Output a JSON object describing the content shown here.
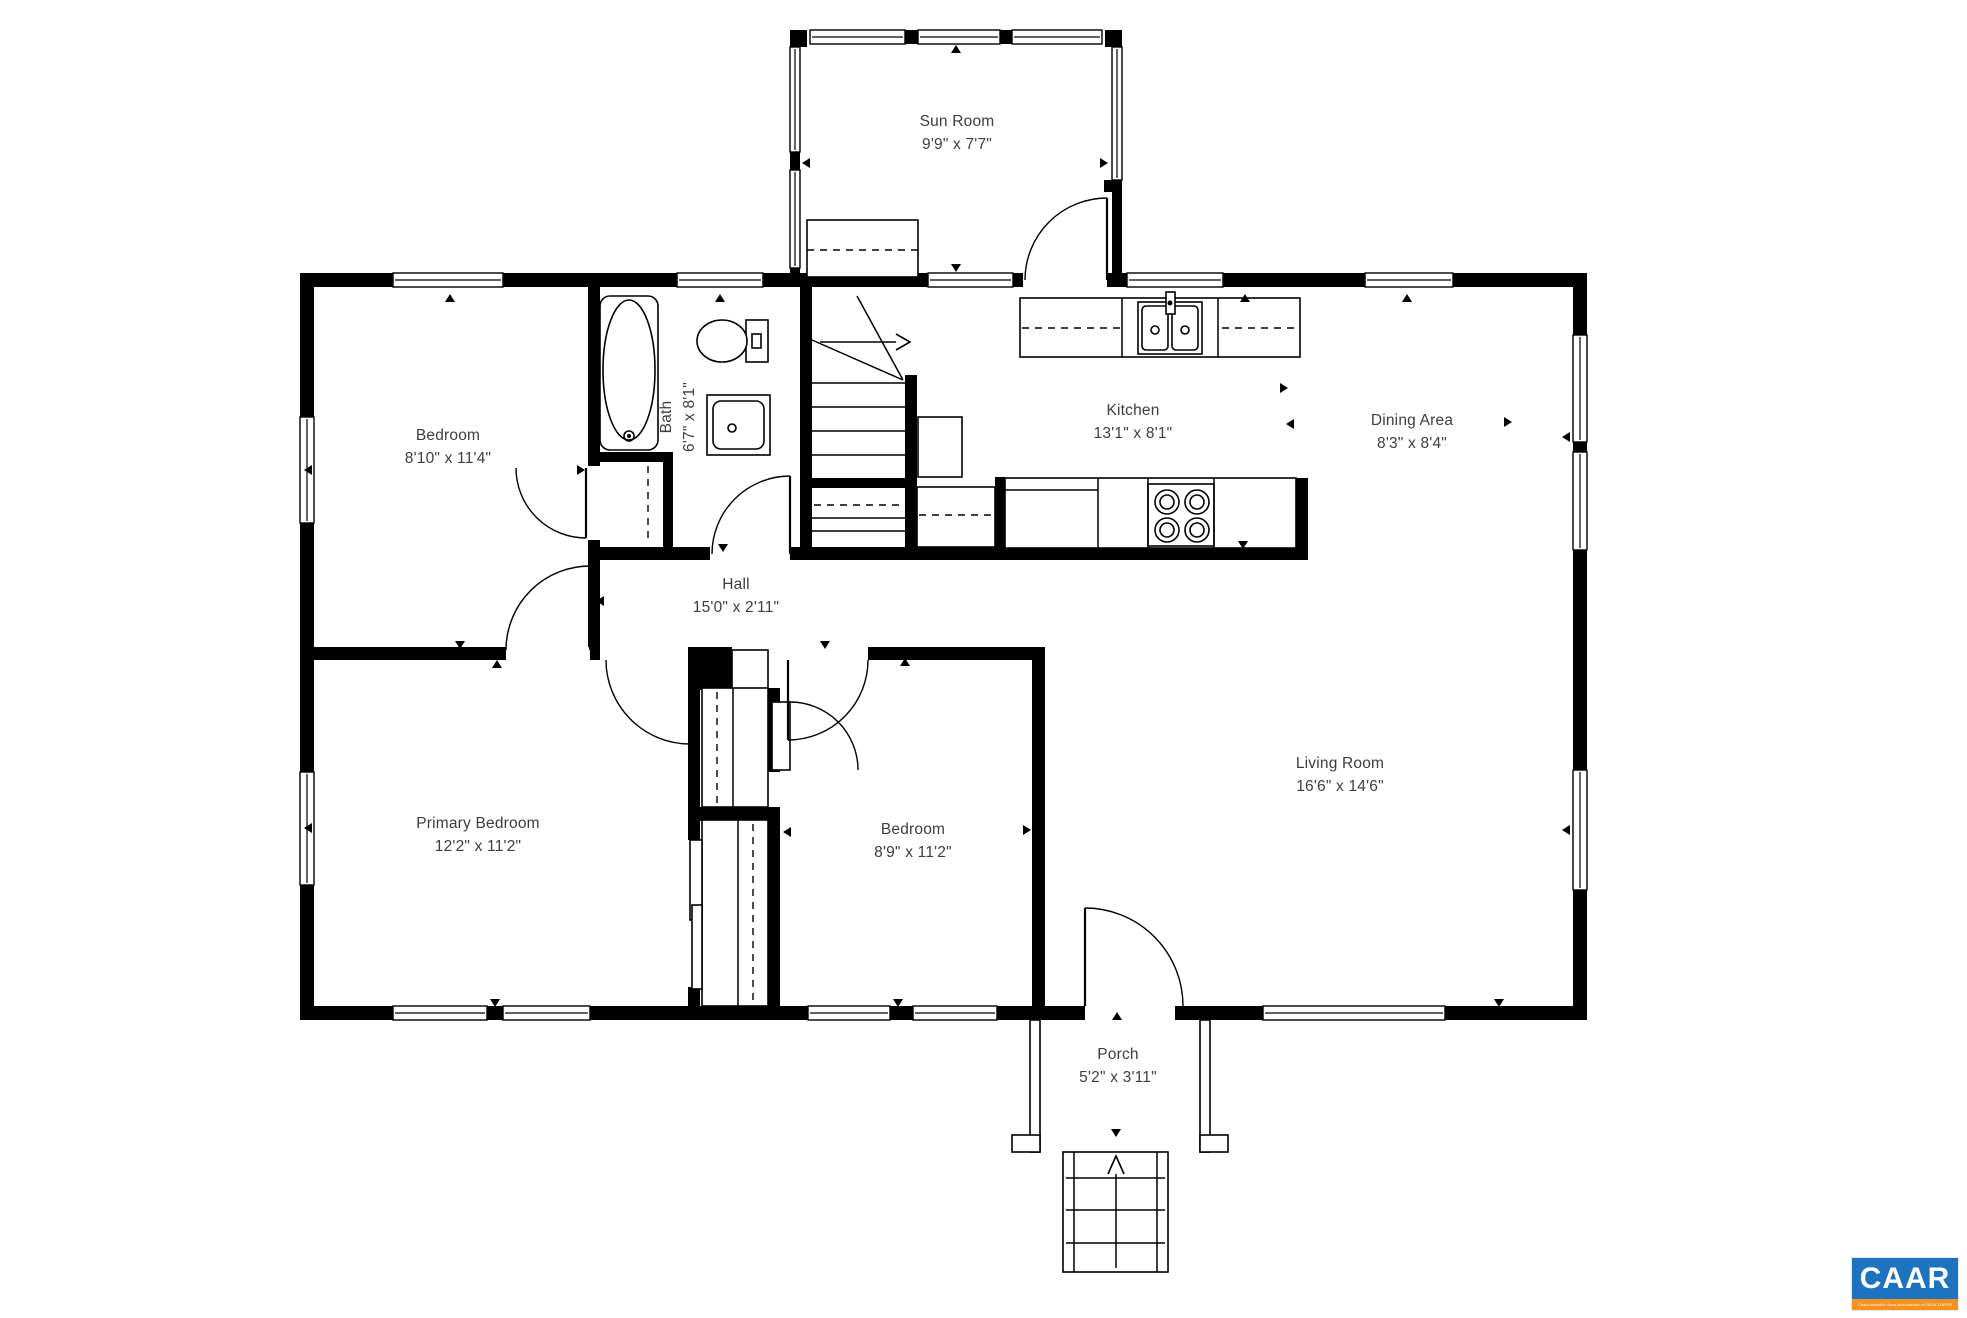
{
  "page": {
    "width": 1967,
    "height": 1318,
    "background": "#ffffff",
    "ink": "#000000",
    "label_color": "#3d3d3d"
  },
  "branding": {
    "logo_text": "CAAR",
    "logo_subtext": "Charlottesville Area Association of REALTORS®",
    "logo_blue": "#1e73be",
    "logo_orange": "#f6921e",
    "x": 1852,
    "y": 1258,
    "w": 106,
    "h": 52
  },
  "rooms": [
    {
      "id": "sun-room",
      "name": "Sun Room",
      "dims": "9'9\" x 7'7\"",
      "x": 957,
      "y": 133,
      "rot": false
    },
    {
      "id": "bedroom-top",
      "name": "Bedroom",
      "dims": "8'10\" x 11'4\"",
      "x": 448,
      "y": 447,
      "rot": false
    },
    {
      "id": "bath",
      "name": "Bath",
      "dims": "6'7\" x 8'1\"",
      "x": 678,
      "y": 417,
      "rot": true
    },
    {
      "id": "kitchen",
      "name": "Kitchen",
      "dims": "13'1\" x 8'1\"",
      "x": 1133,
      "y": 422,
      "rot": false
    },
    {
      "id": "dining-area",
      "name": "Dining Area",
      "dims": "8'3\" x 8'4\"",
      "x": 1412,
      "y": 432,
      "rot": false
    },
    {
      "id": "hall",
      "name": "Hall",
      "dims": "15'0\" x 2'11\"",
      "x": 736,
      "y": 596,
      "rot": false
    },
    {
      "id": "primary-bedroom",
      "name": "Primary Bedroom",
      "dims": "12'2\" x 11'2\"",
      "x": 478,
      "y": 835,
      "rot": false
    },
    {
      "id": "bedroom-bottom",
      "name": "Bedroom",
      "dims": "8'9\" x 11'2\"",
      "x": 913,
      "y": 841,
      "rot": false
    },
    {
      "id": "living-room",
      "name": "Living Room",
      "dims": "16'6\" x 14'6\"",
      "x": 1340,
      "y": 775,
      "rot": false
    },
    {
      "id": "porch",
      "name": "Porch",
      "dims": "5'2\" x 3'11\"",
      "x": 1118,
      "y": 1066,
      "rot": false
    }
  ],
  "plan": {
    "walls": [
      [
        300,
        273,
        93,
        14
      ],
      [
        503,
        273,
        174,
        14
      ],
      [
        763,
        273,
        165,
        14
      ],
      [
        1013,
        273,
        10,
        14
      ],
      [
        1107,
        273,
        20,
        14
      ],
      [
        1223,
        273,
        142,
        14
      ],
      [
        1453,
        273,
        134,
        14
      ],
      [
        300,
        1006,
        93,
        14
      ],
      [
        487,
        1006,
        16,
        14
      ],
      [
        590,
        1006,
        218,
        14
      ],
      [
        890,
        1006,
        23,
        14
      ],
      [
        997,
        1006,
        88,
        14
      ],
      [
        1175,
        1006,
        88,
        14
      ],
      [
        1445,
        1006,
        142,
        14
      ],
      [
        300,
        273,
        14,
        144
      ],
      [
        300,
        523,
        14,
        249
      ],
      [
        300,
        885,
        14,
        135
      ],
      [
        1573,
        273,
        14,
        62
      ],
      [
        1573,
        442,
        14,
        10
      ],
      [
        1573,
        550,
        14,
        220
      ],
      [
        1573,
        890,
        14,
        130
      ],
      [
        790,
        30,
        17,
        17
      ],
      [
        1105,
        30,
        17,
        17
      ],
      [
        905,
        30,
        13,
        14
      ],
      [
        1000,
        30,
        12,
        14
      ],
      [
        790,
        152,
        10,
        18
      ],
      [
        790,
        268,
        10,
        19
      ],
      [
        1112,
        180,
        10,
        93
      ],
      [
        1104,
        180,
        18,
        12
      ],
      [
        588,
        287,
        12,
        179
      ],
      [
        588,
        540,
        12,
        107
      ],
      [
        592,
        452,
        81,
        10
      ],
      [
        663,
        462,
        10,
        85
      ],
      [
        800,
        287,
        12,
        273
      ],
      [
        905,
        375,
        12,
        185
      ],
      [
        812,
        478,
        93,
        10
      ],
      [
        590,
        547,
        120,
        13
      ],
      [
        790,
        547,
        518,
        13
      ],
      [
        995,
        477,
        10,
        70
      ],
      [
        1296,
        478,
        12,
        69
      ],
      [
        300,
        647,
        206,
        13
      ],
      [
        590,
        647,
        10,
        13
      ],
      [
        868,
        647,
        177,
        13
      ],
      [
        688,
        647,
        44,
        43
      ],
      [
        688,
        650,
        12,
        190
      ],
      [
        688,
        807,
        92,
        14
      ],
      [
        768,
        688,
        12,
        84
      ],
      [
        768,
        820,
        12,
        186
      ],
      [
        688,
        987,
        12,
        19
      ],
      [
        1032,
        647,
        13,
        359
      ]
    ],
    "windows": [
      [
        393,
        273,
        110,
        14
      ],
      [
        677,
        273,
        86,
        14
      ],
      [
        1127,
        273,
        96,
        14
      ],
      [
        1365,
        273,
        88,
        14
      ],
      [
        393,
        1006,
        94,
        14
      ],
      [
        503,
        1006,
        87,
        14
      ],
      [
        808,
        1006,
        82,
        14
      ],
      [
        913,
        1006,
        84,
        14
      ],
      [
        1263,
        1006,
        182,
        14
      ],
      [
        300,
        417,
        14,
        106
      ],
      [
        300,
        772,
        14,
        113
      ],
      [
        1573,
        335,
        14,
        107
      ],
      [
        1573,
        452,
        14,
        98
      ],
      [
        1573,
        770,
        14,
        120
      ],
      [
        810,
        30,
        95,
        14
      ],
      [
        918,
        30,
        82,
        14
      ],
      [
        1012,
        30,
        90,
        14
      ],
      [
        790,
        47,
        10,
        105
      ],
      [
        790,
        170,
        10,
        98
      ],
      [
        1112,
        47,
        10,
        133
      ],
      [
        928,
        273,
        85,
        14
      ]
    ],
    "fixture_rects": [
      {
        "r": [
          600,
          296,
          58,
          154
        ],
        "rx": 10,
        "n": "bathtub"
      },
      {
        "r": [
          707,
          395,
          63,
          60
        ],
        "n": "bath-vanity"
      },
      {
        "r": [
          713,
          401,
          51,
          48
        ],
        "rx": 8,
        "n": "bath-sink-basin"
      },
      {
        "r": [
          746,
          320,
          22,
          42
        ],
        "n": "toilet-tank"
      },
      {
        "r": [
          752,
          334,
          9,
          14
        ],
        "n": "toilet-flush"
      },
      {
        "r": [
          918,
          417,
          44,
          60
        ],
        "n": "refrigerator"
      },
      {
        "r": [
          807,
          220,
          111,
          57
        ],
        "n": "sunroom-cabinet"
      },
      {
        "r": [
          1020,
          298,
          280,
          59
        ],
        "n": "kitchen-counter-top"
      },
      {
        "r": [
          1138,
          302,
          64,
          52
        ],
        "n": "kitchen-sink"
      },
      {
        "r": [
          1142,
          306,
          26,
          44
        ],
        "rx": 4,
        "n": "sink-bowl-left"
      },
      {
        "r": [
          1172,
          306,
          26,
          44
        ],
        "rx": 4,
        "n": "sink-bowl-right"
      },
      {
        "r": [
          1166,
          292,
          9,
          22
        ],
        "n": "sink-faucet"
      },
      {
        "r": [
          917,
          487,
          78,
          60
        ],
        "n": "cabinet-under-stair"
      },
      {
        "r": [
          1005,
          478,
          291,
          70
        ],
        "n": "kitchen-counter-bottom"
      },
      {
        "r": [
          1148,
          484,
          66,
          62
        ],
        "n": "stove"
      },
      {
        "r": [
          732,
          650,
          36,
          40
        ],
        "n": "closet-panel"
      },
      {
        "r": [
          702,
          688,
          66,
          119
        ],
        "n": "closet-upper"
      },
      {
        "r": [
          772,
          702,
          18,
          68
        ],
        "n": "closet-door-leaf"
      },
      {
        "r": [
          702,
          820,
          66,
          186
        ],
        "n": "closet-lower"
      },
      {
        "r": [
          690,
          840,
          12,
          80
        ],
        "n": "slider-panel-1"
      },
      {
        "r": [
          692,
          905,
          10,
          84
        ],
        "n": "slider-panel-2"
      },
      {
        "r": [
          1063,
          1152,
          105,
          120
        ],
        "n": "porch-steps"
      },
      {
        "r": [
          1030,
          1020,
          10,
          132
        ],
        "n": "porch-wall-left"
      },
      {
        "r": [
          1200,
          1020,
          10,
          132
        ],
        "n": "porch-wall-right"
      },
      {
        "r": [
          1012,
          1135,
          28,
          17
        ],
        "n": "porch-footer-left"
      },
      {
        "r": [
          1200,
          1135,
          28,
          17
        ],
        "n": "porch-footer-right"
      }
    ],
    "lines": [
      [
        812,
        383,
        905,
        383
      ],
      [
        812,
        407,
        905,
        407
      ],
      [
        812,
        431,
        905,
        431
      ],
      [
        812,
        455,
        905,
        455
      ],
      [
        812,
        518,
        905,
        518
      ],
      [
        812,
        531,
        905,
        531
      ],
      [
        857,
        296,
        903,
        380
      ],
      [
        812,
        340,
        903,
        380
      ],
      [
        820,
        342,
        896,
        342
      ],
      [
        1122,
        298,
        1122,
        357
      ],
      [
        1218,
        298,
        1218,
        357
      ],
      [
        1098,
        478,
        1098,
        548
      ],
      [
        1148,
        478,
        1148,
        548
      ],
      [
        1214,
        478,
        1214,
        548
      ],
      [
        1005,
        490,
        1098,
        490
      ],
      [
        1066,
        1178,
        1165,
        1178
      ],
      [
        1066,
        1210,
        1165,
        1210
      ],
      [
        1066,
        1243,
        1165,
        1243
      ],
      [
        1074,
        1152,
        1074,
        1272
      ],
      [
        1157,
        1152,
        1157,
        1272
      ],
      [
        1116,
        1268,
        1116,
        1172
      ],
      [
        733,
        688,
        733,
        807
      ],
      [
        738,
        820,
        738,
        1006
      ]
    ],
    "dashed_lines": [
      [
        807,
        250,
        918,
        250
      ],
      [
        1022,
        328,
        1122,
        328
      ],
      [
        1222,
        328,
        1296,
        328
      ],
      [
        814,
        505,
        903,
        505
      ],
      [
        919,
        515,
        993,
        515
      ],
      [
        648,
        466,
        648,
        540
      ],
      [
        717,
        692,
        717,
        803
      ],
      [
        753,
        824,
        753,
        1002
      ]
    ],
    "ellipses": [
      {
        "e": [
          629,
          370,
          26,
          70
        ],
        "n": "bathtub-basin"
      },
      {
        "e": [
          722,
          341,
          25,
          21
        ],
        "n": "toilet-bowl"
      }
    ],
    "circles": [
      {
        "c": [
          1167,
          502,
          12
        ],
        "n": "burner"
      },
      {
        "c": [
          1167,
          502,
          7
        ],
        "n": "burner"
      },
      {
        "c": [
          1197,
          502,
          12
        ],
        "n": "burner"
      },
      {
        "c": [
          1197,
          502,
          7
        ],
        "n": "burner"
      },
      {
        "c": [
          1167,
          530,
          12
        ],
        "n": "burner"
      },
      {
        "c": [
          1167,
          530,
          7
        ],
        "n": "burner"
      },
      {
        "c": [
          1197,
          530,
          12
        ],
        "n": "burner"
      },
      {
        "c": [
          1197,
          530,
          7
        ],
        "n": "burner"
      },
      {
        "c": [
          1155,
          330,
          4
        ],
        "n": "sink-drain"
      },
      {
        "c": [
          1185,
          330,
          4
        ],
        "n": "sink-drain"
      },
      {
        "c": [
          732,
          428,
          4
        ],
        "n": "vanity-faucet"
      },
      {
        "c": [
          629,
          436,
          5
        ],
        "n": "tub-faucet"
      }
    ],
    "dots": [
      [
        1170,
        303,
        2.5
      ],
      [
        629,
        436,
        2
      ]
    ],
    "doors": [
      {
        "leaf": [
          1107,
          198,
          1107,
          280
        ],
        "arc": "M 1025 280 A 82 82 0 0 1 1107 198",
        "n": "door-sunroom"
      },
      {
        "leaf": [
          586,
          468,
          586,
          538
        ],
        "arc": "M 516 468 A 70 70 0 0 0 586 538",
        "n": "door-bedroom-closet"
      },
      {
        "leaf": [
          790,
          476,
          790,
          554
        ],
        "arc": "M 712 554 A 78 78 0 0 1 790 476",
        "n": "door-bath"
      },
      {
        "leaf": [
          590,
          566,
          590,
          650
        ],
        "arc": "M 506 650 A 84 84 0 0 1 590 566",
        "n": "door-bedroom-top"
      },
      {
        "leaf": [
          690,
          660,
          690,
          744
        ],
        "arc": "M 606 660 A 84 84 0 0 0 690 744",
        "n": "door-primary-bedroom"
      },
      {
        "leaf": [
          788,
          660,
          788,
          740
        ],
        "arc": "M 868 660 A 80 80 0 0 1 788 740",
        "n": "door-bedroom-bottom"
      },
      {
        "leaf": [
          790,
          702,
          790,
          702
        ],
        "arc": "M 790 702 A 68 68 0 0 1 858 770",
        "n": "door-closet-bottom"
      },
      {
        "leaf": [
          1085,
          908,
          1085,
          1006
        ],
        "arc": "M 1085 908 A 98 98 0 0 1 1183 1006",
        "n": "door-front-entry"
      }
    ],
    "markers": {
      "up": [
        [
          450,
          298
        ],
        [
          720,
          298
        ],
        [
          1245,
          298
        ],
        [
          1407,
          298
        ],
        [
          956,
          49
        ],
        [
          1117,
          1016
        ],
        [
          497,
          664
        ],
        [
          905,
          662
        ]
      ],
      "down": [
        [
          956,
          268
        ],
        [
          723,
          548
        ],
        [
          1243,
          545
        ],
        [
          825,
          645
        ],
        [
          460,
          645
        ],
        [
          495,
          1003
        ],
        [
          898,
          1003
        ],
        [
          1499,
          1003
        ],
        [
          1116,
          1133
        ]
      ],
      "left": [
        [
          806,
          163
        ],
        [
          1566,
          437
        ],
        [
          1566,
          830
        ],
        [
          308,
          470
        ],
        [
          308,
          828
        ],
        [
          600,
          601
        ],
        [
          910,
          388
        ],
        [
          787,
          832
        ],
        [
          1290,
          424
        ]
      ],
      "right": [
        [
          1104,
          163
        ],
        [
          1508,
          422
        ],
        [
          581,
          470
        ],
        [
          1027,
          830
        ],
        [
          693,
          832
        ],
        [
          1284,
          388
        ]
      ]
    },
    "open_arrows": [
      {
        "pts": "896,334 910,342 896,350",
        "n": "stair-up-arrow-head"
      },
      {
        "pts": "1108,1174 1116,1156 1124,1174",
        "n": "steps-up-arrow-head"
      }
    ]
  }
}
